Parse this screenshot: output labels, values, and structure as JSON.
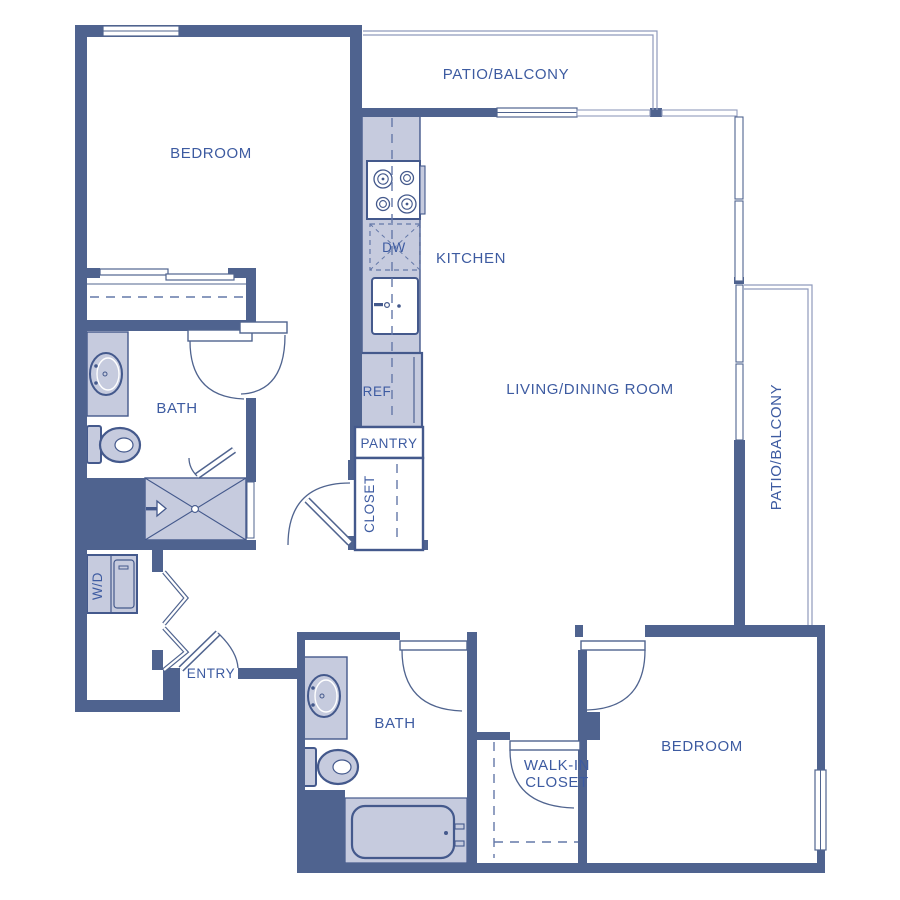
{
  "floorplan": {
    "rooms": {
      "bedroom_top": "BEDROOM",
      "bedroom_bottom": "BEDROOM",
      "bath_top": "BATH",
      "bath_bottom": "BATH",
      "kitchen": "KITCHEN",
      "living_dining": "LIVING/DINING ROOM",
      "patio_top": "PATIO/BALCONY",
      "patio_right": "PATIO/BALCONY",
      "entry": "ENTRY",
      "hall_closet": "CLOSET",
      "pantry": "PANTRY",
      "walk_in_closet_line1": "WALK-IN",
      "walk_in_closet_line2": "CLOSET"
    },
    "appliances": {
      "dishwasher": "DW",
      "refrigerator": "REF",
      "washer_dryer": "W/D"
    },
    "colors": {
      "wall": "#4f638f",
      "fixture_fill": "#c6cbde",
      "label_text": "#3d5ba1",
      "patio_outline": "#8f9abc",
      "background": "#ffffff"
    }
  }
}
